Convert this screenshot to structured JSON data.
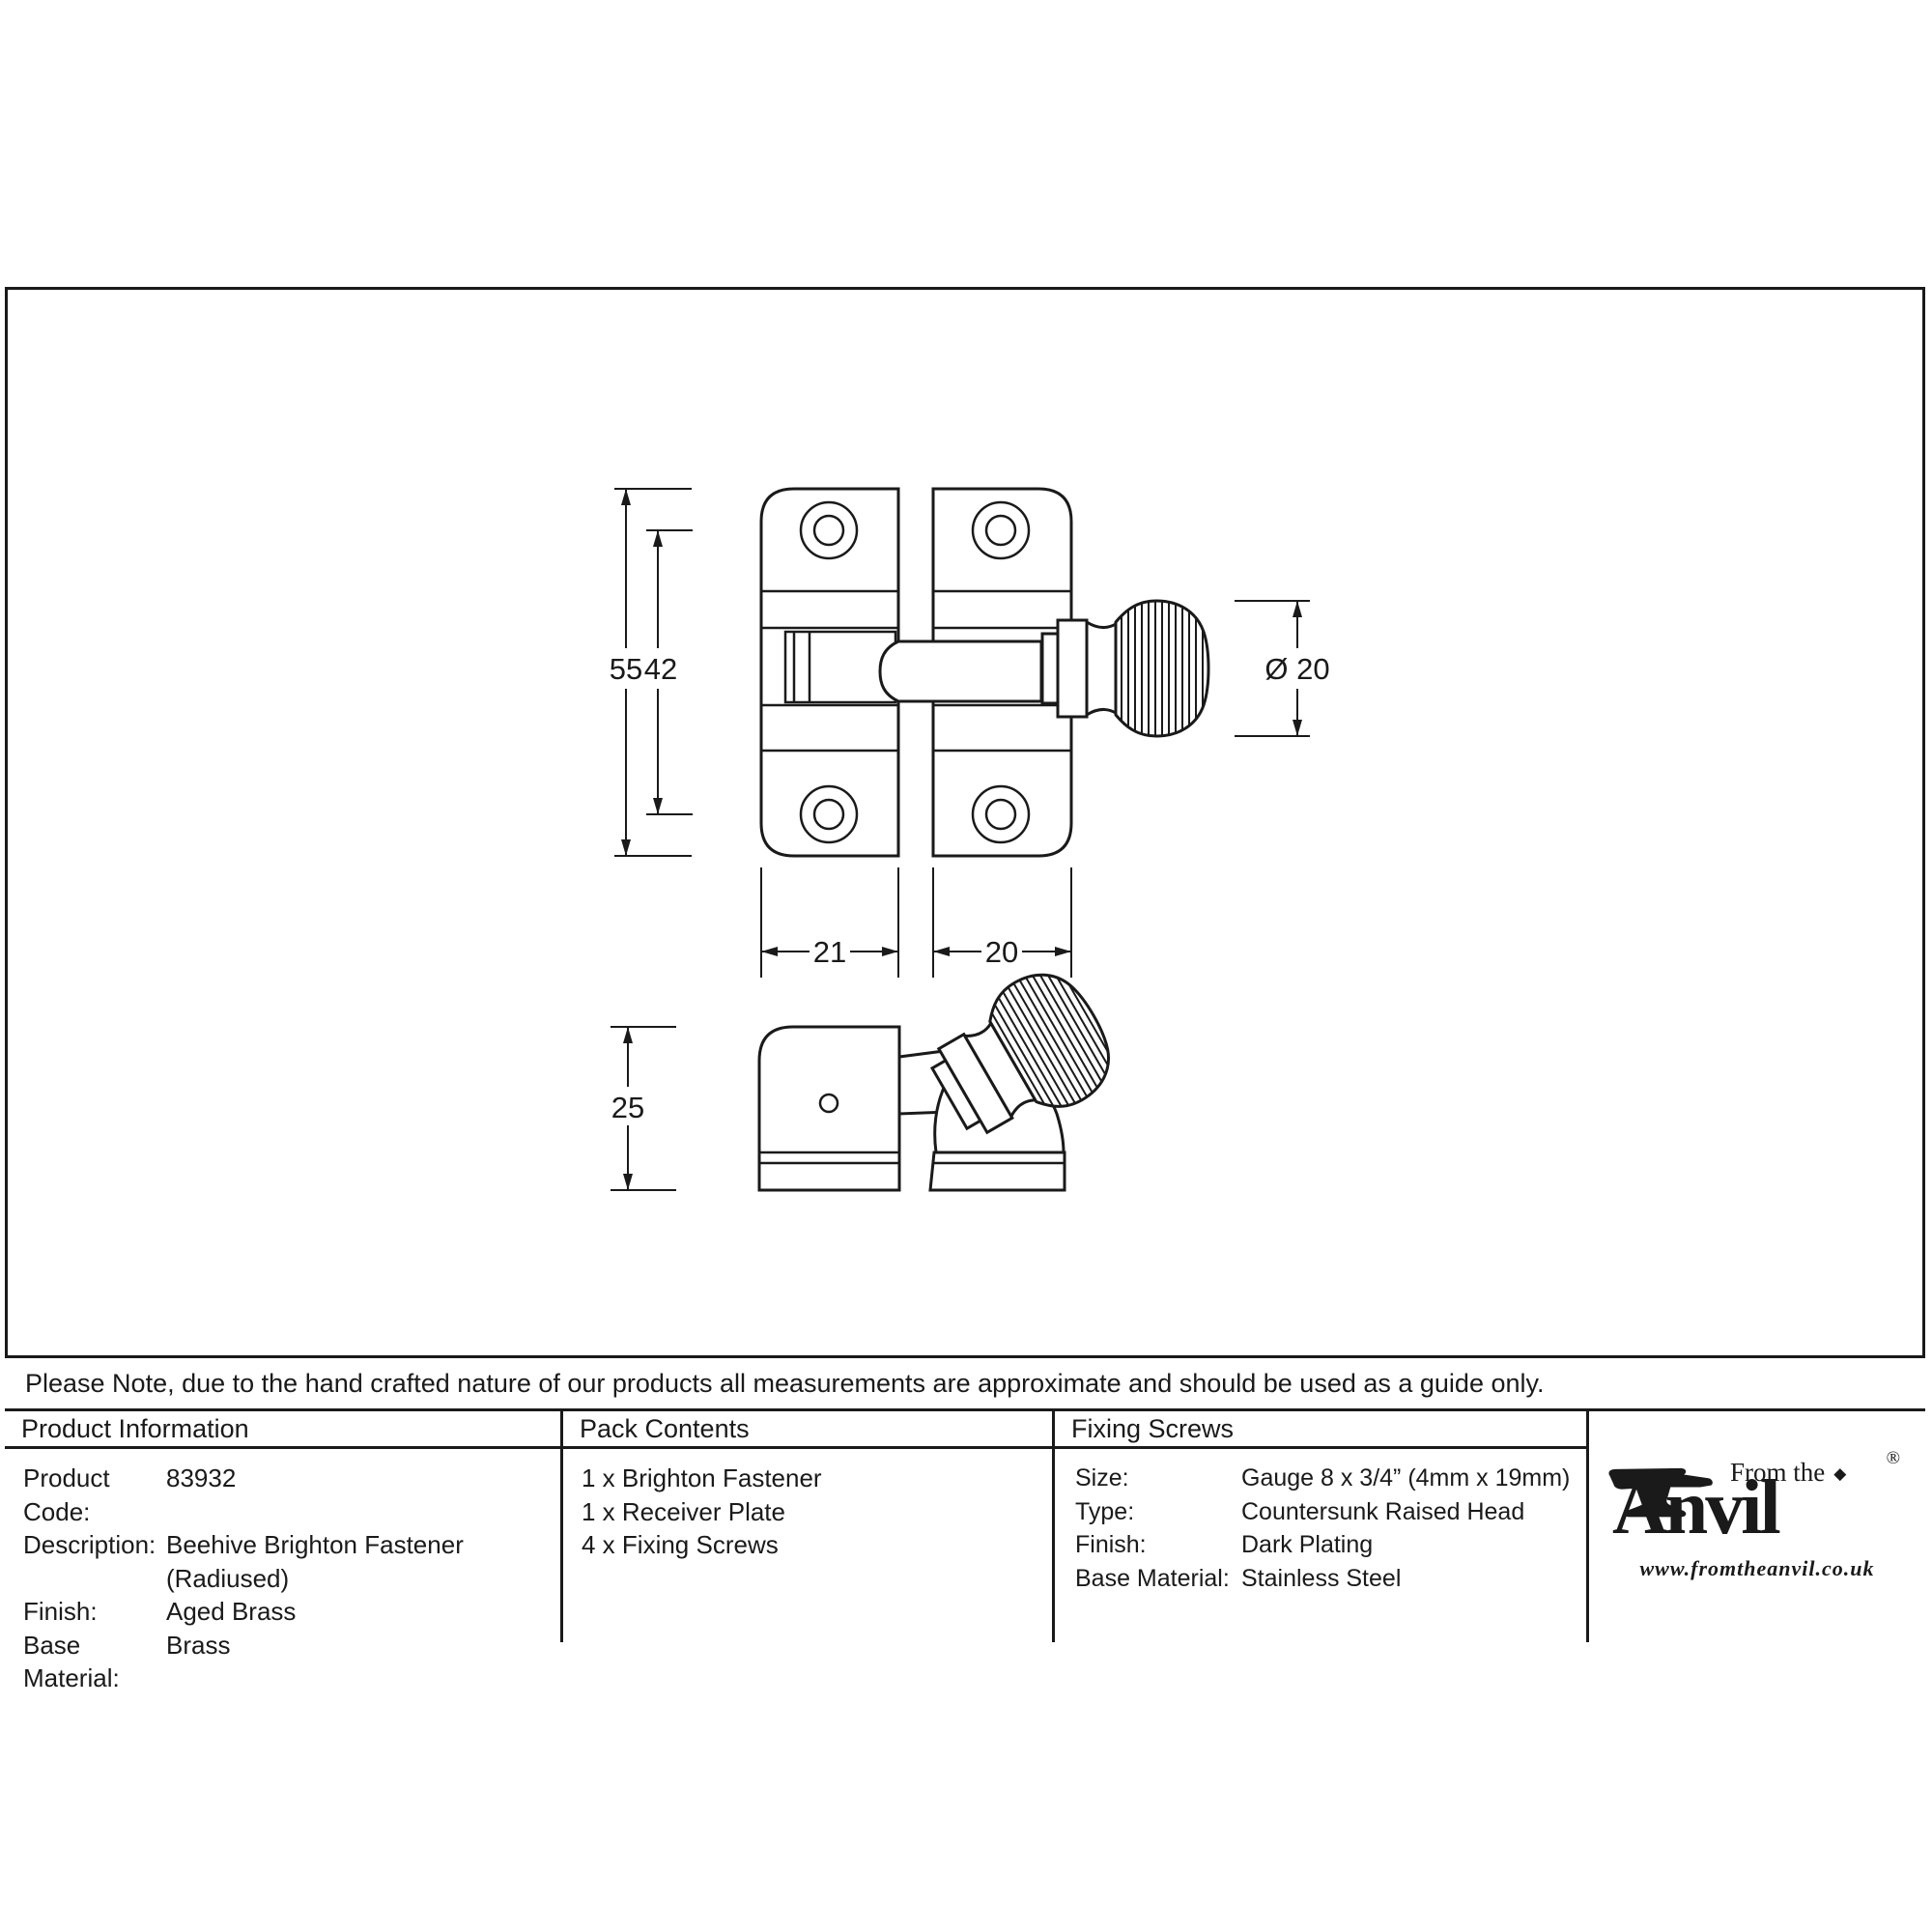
{
  "drawing": {
    "labels": {
      "height_overall": "55",
      "height_inner": "42",
      "width_left": "21",
      "width_right": "20",
      "depth": "25",
      "knob_diameter": "Ø 20"
    }
  },
  "note": {
    "text": "Please Note, due to the hand crafted nature of our products all measurements are approximate and should be used as a guide only."
  },
  "table": {
    "product_information": {
      "header": "Product Information",
      "rows": [
        {
          "label": "Product Code:",
          "value": "83932"
        },
        {
          "label": "Description:",
          "value": "Beehive Brighton Fastener",
          "value2": "(Radiused)"
        },
        {
          "label": "Finish:",
          "value": "Aged Brass"
        },
        {
          "label": "Base Material:",
          "value": "Brass"
        }
      ]
    },
    "pack_contents": {
      "header": "Pack Contents",
      "items": [
        "1 x Brighton Fastener",
        "1 x Receiver Plate",
        "4 x Fixing Screws"
      ]
    },
    "fixing_screws": {
      "header": "Fixing Screws",
      "rows": [
        {
          "label": "Size:",
          "value": "Gauge 8 x 3/4” (4mm x 19mm)"
        },
        {
          "label": "Type:",
          "value": "Countersunk Raised Head"
        },
        {
          "label": "Finish:",
          "value": "Dark Plating"
        },
        {
          "label": "Base Material:",
          "value": "Stainless Steel"
        }
      ]
    }
  },
  "logo": {
    "tagline": "From the",
    "diamond": "◆",
    "wordmark": "Anvil",
    "registered": "®",
    "url": "www.fromtheanvil.co.uk"
  }
}
